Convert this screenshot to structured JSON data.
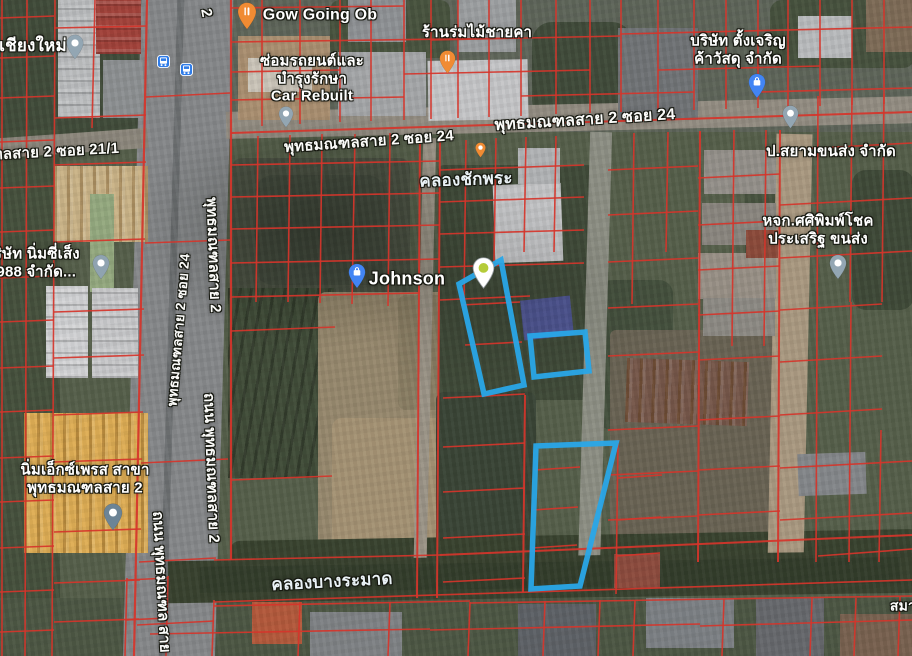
{
  "map": {
    "type": "satellite",
    "width": 912,
    "height": 656
  },
  "colors": {
    "parcel_highlight": "#29a6e8",
    "cadastral_line": "#d6352b",
    "pin_gray": "#93a6b3",
    "pin_orange": "#f08b33",
    "pin_blue": "#4285f4",
    "pin_slate": "#6c8496",
    "pin_dropped": "#ffffff",
    "bus_icon": "#2f7ce8"
  },
  "road_labels": [
    {
      "name": "road-label-soi-21-1",
      "text": "ทลสาย 2 ซอย 21/1",
      "x": 56,
      "y": 152,
      "rot": -3,
      "size": 15
    },
    {
      "name": "road-label-2-top",
      "text": "2",
      "x": 206,
      "y": 13,
      "rot": 80,
      "size": 15
    },
    {
      "name": "road-label-sai2-soi24-a",
      "text": "พุทธมณฑลสาย 2 ซอย 24",
      "x": 369,
      "y": 142,
      "rot": -4,
      "size": 15
    },
    {
      "name": "road-label-sai2-soi24-b",
      "text": "พุทธมณฑลสาย 2 ซอย 24",
      "x": 585,
      "y": 121,
      "rot": -3.5,
      "size": 16
    },
    {
      "name": "road-label-sai2-vertical-upper",
      "text": "พุทธมณฑลสาย 2",
      "x": 213,
      "y": 255,
      "rot": 88,
      "size": 15
    },
    {
      "name": "road-label-soi24-vertical",
      "text": "พุทธมณฑลสาย 2 ซอย 24",
      "x": 179,
      "y": 330,
      "rot": -85,
      "size": 13.5
    },
    {
      "name": "road-label-thanon-sai2-lower",
      "text": "ถนน พุทธมณฑลสาย 2",
      "x": 211,
      "y": 468,
      "rot": 88,
      "size": 15
    },
    {
      "name": "road-label-thanon-bottom-left",
      "text": "ถนน พุทธมณฑล สาย",
      "x": 161,
      "y": 582,
      "rot": 87,
      "size": 15
    }
  ],
  "water_labels": [
    {
      "name": "water-label-khlong-chak-phra",
      "text": "คลองชักพระ",
      "x": 466,
      "y": 180,
      "rot": -2,
      "size": 17
    },
    {
      "name": "water-label-khlong-bang-ramat",
      "text": "คลองบางระมาด",
      "x": 332,
      "y": 582,
      "rot": -3,
      "size": 17
    }
  ],
  "poi_labels": [
    {
      "name": "poi-chiang-mai",
      "lines": [
        "เชียงใหม่"
      ],
      "x": 33,
      "y": 46,
      "size": 17
    },
    {
      "name": "poi-gow-going-ob",
      "lines": [
        "Gow Going Ob"
      ],
      "x": 320,
      "y": 16,
      "size": 16
    },
    {
      "name": "poi-car-rebuilt",
      "lines": [
        "ซ่อมรถยนต์และ",
        "บำรุงรักษา",
        "Car Rebuilt"
      ],
      "x": 312,
      "y": 79,
      "size": 15
    },
    {
      "name": "poi-ran-rom-mai-chai-kha",
      "lines": [
        "ร้านร่มไม้ชายคา"
      ],
      "x": 477,
      "y": 33,
      "size": 15
    },
    {
      "name": "poi-tang-charoen",
      "lines": [
        "บริษัท ตั้งเจริญ",
        "ค้าวัสดุ จำกัด"
      ],
      "x": 738,
      "y": 50,
      "size": 15
    },
    {
      "name": "poi-siam-transport",
      "lines": [
        "ป.สยามขนส่ง จำกัด"
      ],
      "x": 831,
      "y": 152,
      "size": 15
    },
    {
      "name": "poi-sasipimchok-transport",
      "lines": [
        "หจก.ศศิพิมพ์โชค",
        "ประเสริฐ ขนส่ง"
      ],
      "x": 818,
      "y": 230,
      "size": 15
    },
    {
      "name": "poi-nim-see-seng-1988",
      "lines": [
        "บริษัท นิ่มซี่เส็ง",
        "1988 จำกัด..."
      ],
      "x": 32,
      "y": 263,
      "size": 15
    },
    {
      "name": "poi-johnson",
      "lines": [
        "Johnson"
      ],
      "x": 407,
      "y": 279,
      "size": 18
    },
    {
      "name": "poi-nim-express",
      "lines": [
        "นิ่มเอ็กซ์เพรส สาขา",
        "พุทธมณฑลสาย 2"
      ],
      "x": 85,
      "y": 479,
      "size": 15
    },
    {
      "name": "poi-sama",
      "lines": [
        "สมา"
      ],
      "x": 903,
      "y": 606,
      "size": 14
    }
  ],
  "markers": [
    {
      "name": "marker-chiang-mai",
      "icon": "dot",
      "color": "#93a6b3",
      "x": 75,
      "y": 60,
      "size": 26
    },
    {
      "name": "marker-gow-going-ob",
      "icon": "restaurant",
      "color": "#f08b33",
      "x": 247,
      "y": 30,
      "size": 28
    },
    {
      "name": "marker-bus-stop-1",
      "icon": "bus",
      "color": "#2f7ce8",
      "x": 163,
      "y": 61,
      "size": 13
    },
    {
      "name": "marker-bus-stop-2",
      "icon": "bus",
      "color": "#2f7ce8",
      "x": 186,
      "y": 69,
      "size": 13
    },
    {
      "name": "marker-car-rebuilt",
      "icon": "dot",
      "color": "#93a6b3",
      "x": 286,
      "y": 128,
      "size": 22
    },
    {
      "name": "marker-ran-rom-mai",
      "icon": "restaurant",
      "color": "#f08b33",
      "x": 447,
      "y": 74,
      "size": 24
    },
    {
      "name": "marker-tang-charoen",
      "icon": "bag",
      "color": "#4285f4",
      "x": 757,
      "y": 99,
      "size": 26
    },
    {
      "name": "marker-siam-transport",
      "icon": "dot",
      "color": "#93a6b3",
      "x": 790,
      "y": 129,
      "size": 24
    },
    {
      "name": "marker-chak-phra-poi",
      "icon": "dot",
      "color": "#f08b33",
      "x": 480,
      "y": 158,
      "size": 16
    },
    {
      "name": "marker-johnson",
      "icon": "bag",
      "color": "#4285f4",
      "x": 357,
      "y": 289,
      "size": 26
    },
    {
      "name": "marker-dropped-pin",
      "icon": "pin-green",
      "color": "#ffffff",
      "x": 483,
      "y": 289,
      "size": 32
    },
    {
      "name": "marker-sasipimchok",
      "icon": "dot",
      "color": "#93a6b3",
      "x": 838,
      "y": 280,
      "size": 26
    },
    {
      "name": "marker-nim-see-seng",
      "icon": "dot",
      "color": "#8fa3b0",
      "x": 101,
      "y": 280,
      "size": 26
    },
    {
      "name": "marker-nim-express",
      "icon": "dot",
      "color": "#6c8496",
      "x": 113,
      "y": 531,
      "size": 28
    }
  ],
  "highlight_parcels": [
    {
      "name": "highlighted-parcel-a",
      "points": [
        [
          459,
          284
        ],
        [
          501,
          260
        ],
        [
          524,
          385
        ],
        [
          484,
          394
        ]
      ]
    },
    {
      "name": "highlighted-parcel-b",
      "points": [
        [
          530,
          336
        ],
        [
          585,
          332
        ],
        [
          589,
          371
        ],
        [
          534,
          377
        ]
      ]
    },
    {
      "name": "highlighted-parcel-c",
      "points": [
        [
          536,
          446
        ],
        [
          616,
          443
        ],
        [
          580,
          586
        ],
        [
          531,
          589
        ]
      ]
    }
  ]
}
